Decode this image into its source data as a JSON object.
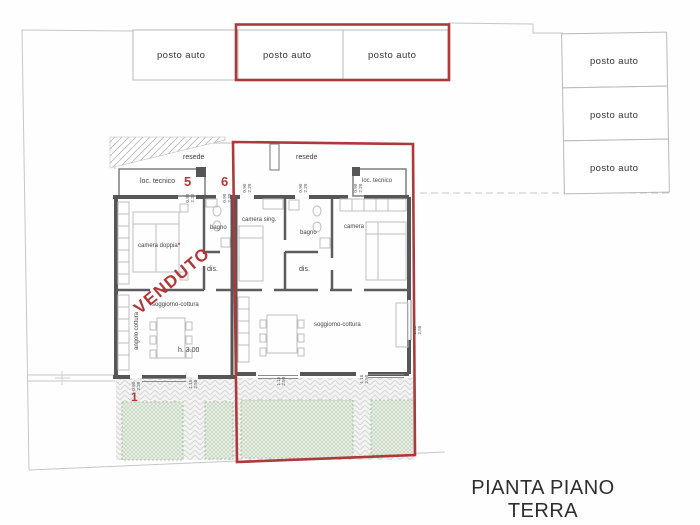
{
  "colors": {
    "accent_red": "#ad3a3a",
    "wall_gray": "#575757",
    "boundary_gray": "#c6c6c6",
    "garden_green": "#b9cfb4",
    "paving_gray": "#d6d6d6"
  },
  "title": "PIANTA PIANO TERRA",
  "parking_top": [
    {
      "label": "posto auto"
    },
    {
      "label": "posto auto"
    },
    {
      "label": "posto auto"
    }
  ],
  "parking_right": [
    {
      "label": "posto auto"
    },
    {
      "label": "posto auto"
    },
    {
      "label": "posto auto"
    }
  ],
  "left_unit": {
    "resede": "resede",
    "loc_tecnico": "loc. tecnico",
    "camera_doppia": "camera doppia",
    "camera_doppia_mark": "*",
    "bagno": "bagno",
    "dis": "dis.",
    "soggiorno": "soggiorno-cottura",
    "angolo_cottura": "angolo cottura",
    "height_note": "h. 3.00",
    "door_number_5": "5",
    "door_number_6": "6",
    "garden_number_1": "1",
    "status_stamp": "VENDUTO"
  },
  "right_unit": {
    "resede": "resede",
    "loc_tecnico": "loc. tecnico",
    "camera_sing": "camera sing.",
    "bagno": "bagno",
    "camera": "camera",
    "dis": "dis.",
    "soggiorno": "soggiorno-cottura"
  },
  "dims": [
    "0.90\n2.20",
    "0.90\n2.20",
    "0.90\n2.20",
    "0.90\n2.20",
    "0.90\n2.20",
    "0.90\n2.20",
    "1.15\n2.50",
    "1.15\n2.50",
    "1.15\n2.50",
    "1.15\n2.50"
  ]
}
